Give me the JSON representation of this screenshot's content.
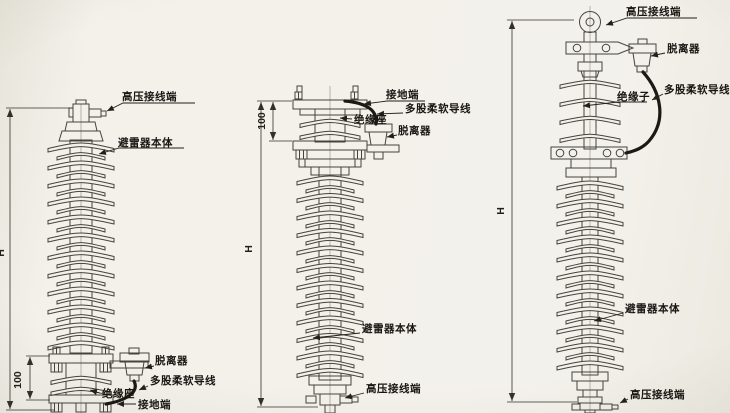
{
  "diagrams": {
    "left": {
      "labels": {
        "hv_terminal": "高压接线端",
        "arrester_body": "避雷器本体",
        "disconnector": "脱离器",
        "flexible_wire": "多股柔软导线",
        "insulating_base": "绝缘座",
        "ground_terminal": "接地端"
      },
      "dimensions": {
        "height": "H",
        "base": "100"
      }
    },
    "middle": {
      "labels": {
        "ground_terminal": "接地端",
        "flexible_wire": "多股柔软导线",
        "insulating_base": "绝缘座",
        "disconnector": "脱离器",
        "arrester_body": "避雷器本体",
        "hv_terminal": "高压接线端"
      },
      "dimensions": {
        "height": "H",
        "top": "100"
      }
    },
    "right": {
      "labels": {
        "hv_terminal_top": "高压接线端",
        "disconnector": "脱离器",
        "flexible_wire": "多股柔软导线",
        "insulator": "绝缘子",
        "arrester_body": "避雷器本体",
        "hv_terminal_bottom": "高压接线端"
      },
      "dimensions": {
        "height": "H"
      }
    }
  },
  "colors": {
    "paper": "#f2f0e9",
    "line": "#45433c",
    "wire": "#1b1914",
    "text": "#181512"
  }
}
